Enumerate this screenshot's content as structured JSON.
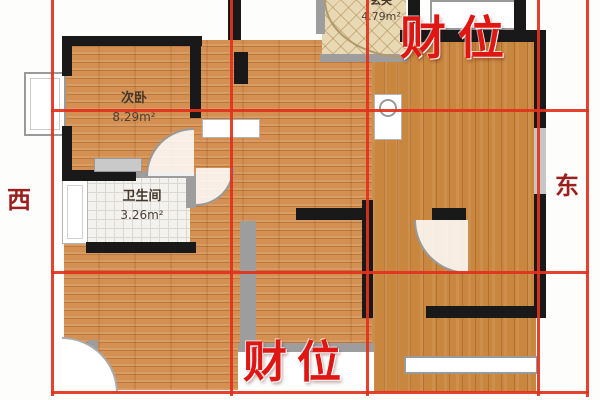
{
  "plan": {
    "compass": {
      "west": "西",
      "east": "东"
    },
    "wealth": {
      "top_right": "财位",
      "bottom_center": "财位"
    },
    "rooms": {
      "bedroom": {
        "name": "次卧",
        "area": "8.29m²"
      },
      "bathroom": {
        "name": "卫生间",
        "area": "3.26m²"
      },
      "entry": {
        "name": "玄关",
        "area": "4.79m²"
      }
    },
    "colors": {
      "grid_red": "#e2311c",
      "wealth_red": "#e01612",
      "compass_red": "#9c1f1f",
      "wall_black": "#191919",
      "wall_gray": "#9d9d9d",
      "wood_light": "#d39052",
      "wood_dark": "#c8863e",
      "bathroom_tile": "#f3f2ee",
      "entry_tile": "#e9d8b4"
    }
  }
}
